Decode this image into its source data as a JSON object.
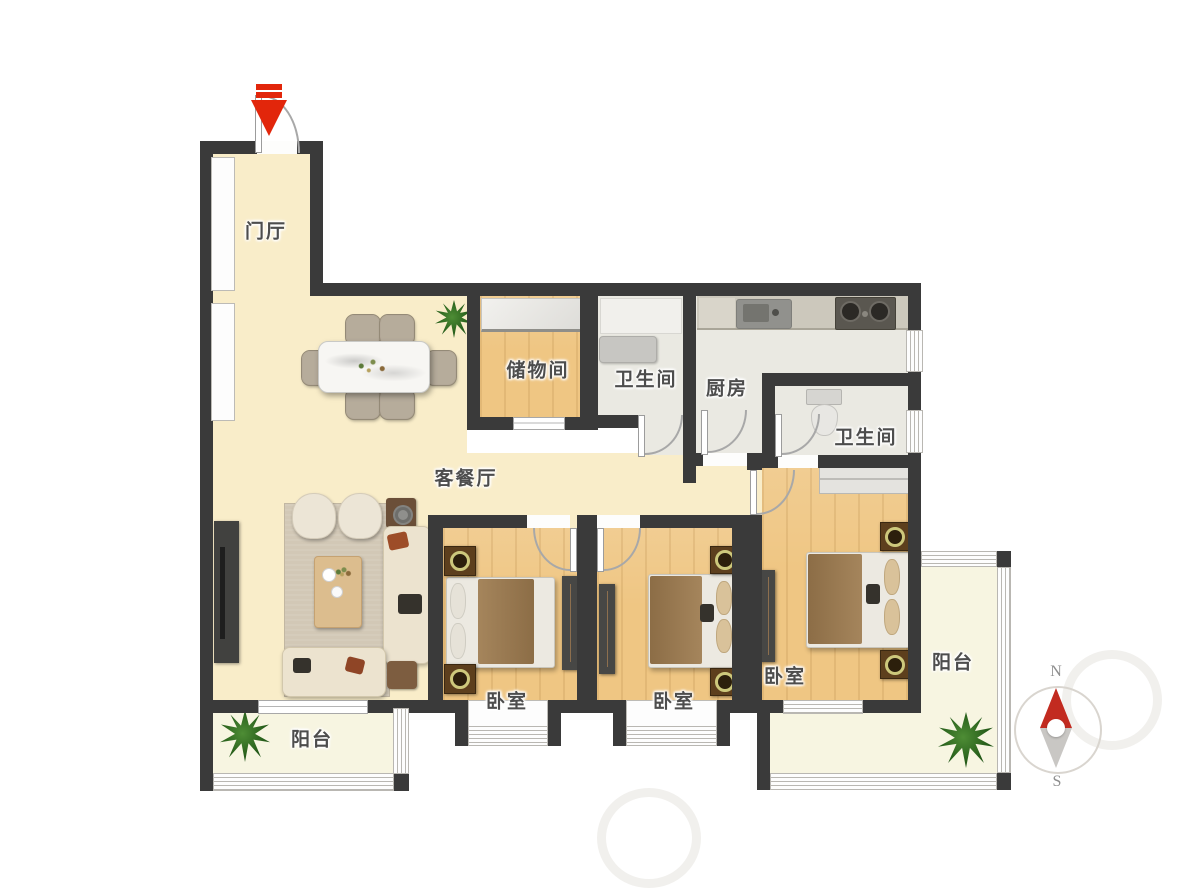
{
  "rooms": [
    {
      "id": "entry-hall",
      "label": "门厅"
    },
    {
      "id": "living-dining",
      "label": "客餐厅"
    },
    {
      "id": "storage",
      "label": "储物间"
    },
    {
      "id": "bathroom-1",
      "label": "卫生间"
    },
    {
      "id": "kitchen",
      "label": "厨房"
    },
    {
      "id": "bathroom-2",
      "label": "卫生间"
    },
    {
      "id": "bedroom-1",
      "label": "卧室"
    },
    {
      "id": "bedroom-2",
      "label": "卧室"
    },
    {
      "id": "master-bedroom",
      "label": "卧室"
    },
    {
      "id": "balcony-left",
      "label": "阳台"
    },
    {
      "id": "balcony-right",
      "label": "阳台"
    }
  ],
  "compass": {
    "north": "N",
    "south": "S"
  },
  "colors": {
    "wall": "#3a3a3a",
    "marble_floor": "#f9edc9",
    "wood_floor": "#efc683",
    "tile_floor": "#eae9e2",
    "balcony_floor": "#f7f5e1",
    "entry_arrow_red": "#e2260b",
    "compass_north_red": "#c22b20",
    "compass_south_gray": "#c9c7c4",
    "furniture_dark": "#474745"
  }
}
